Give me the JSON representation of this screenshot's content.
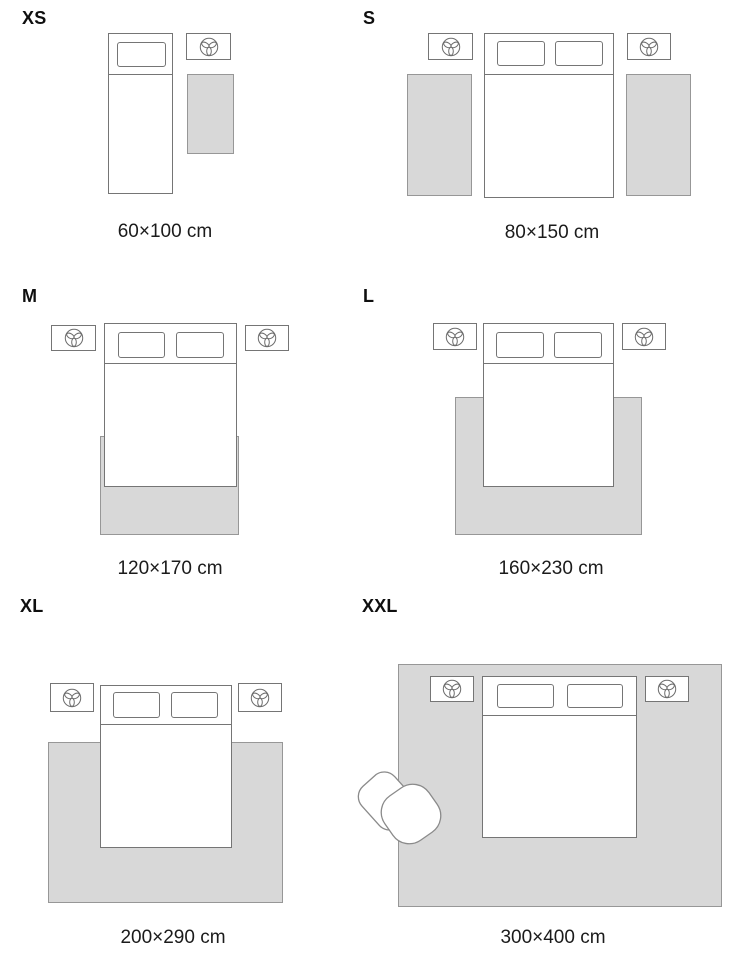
{
  "colors": {
    "background": "#ffffff",
    "rug_fill": "#d8d8d8",
    "rug_border": "#979797",
    "furniture_outline": "#757575",
    "text": "#1b1b1b"
  },
  "panels": [
    {
      "id": "xs",
      "size_label": "XS",
      "dimension_label": "60×100 cm"
    },
    {
      "id": "s",
      "size_label": "S",
      "dimension_label": "80×150 cm"
    },
    {
      "id": "m",
      "size_label": "M",
      "dimension_label": "120×170 cm"
    },
    {
      "id": "l",
      "size_label": "L",
      "dimension_label": "160×230 cm"
    },
    {
      "id": "xl",
      "size_label": "XL",
      "dimension_label": "200×290 cm"
    },
    {
      "id": "xxl",
      "size_label": "XXL",
      "dimension_label": "300×400 cm"
    }
  ],
  "icons": {
    "nightstand_icon": "plant-icon",
    "seat_icon": "armchair-icon"
  }
}
